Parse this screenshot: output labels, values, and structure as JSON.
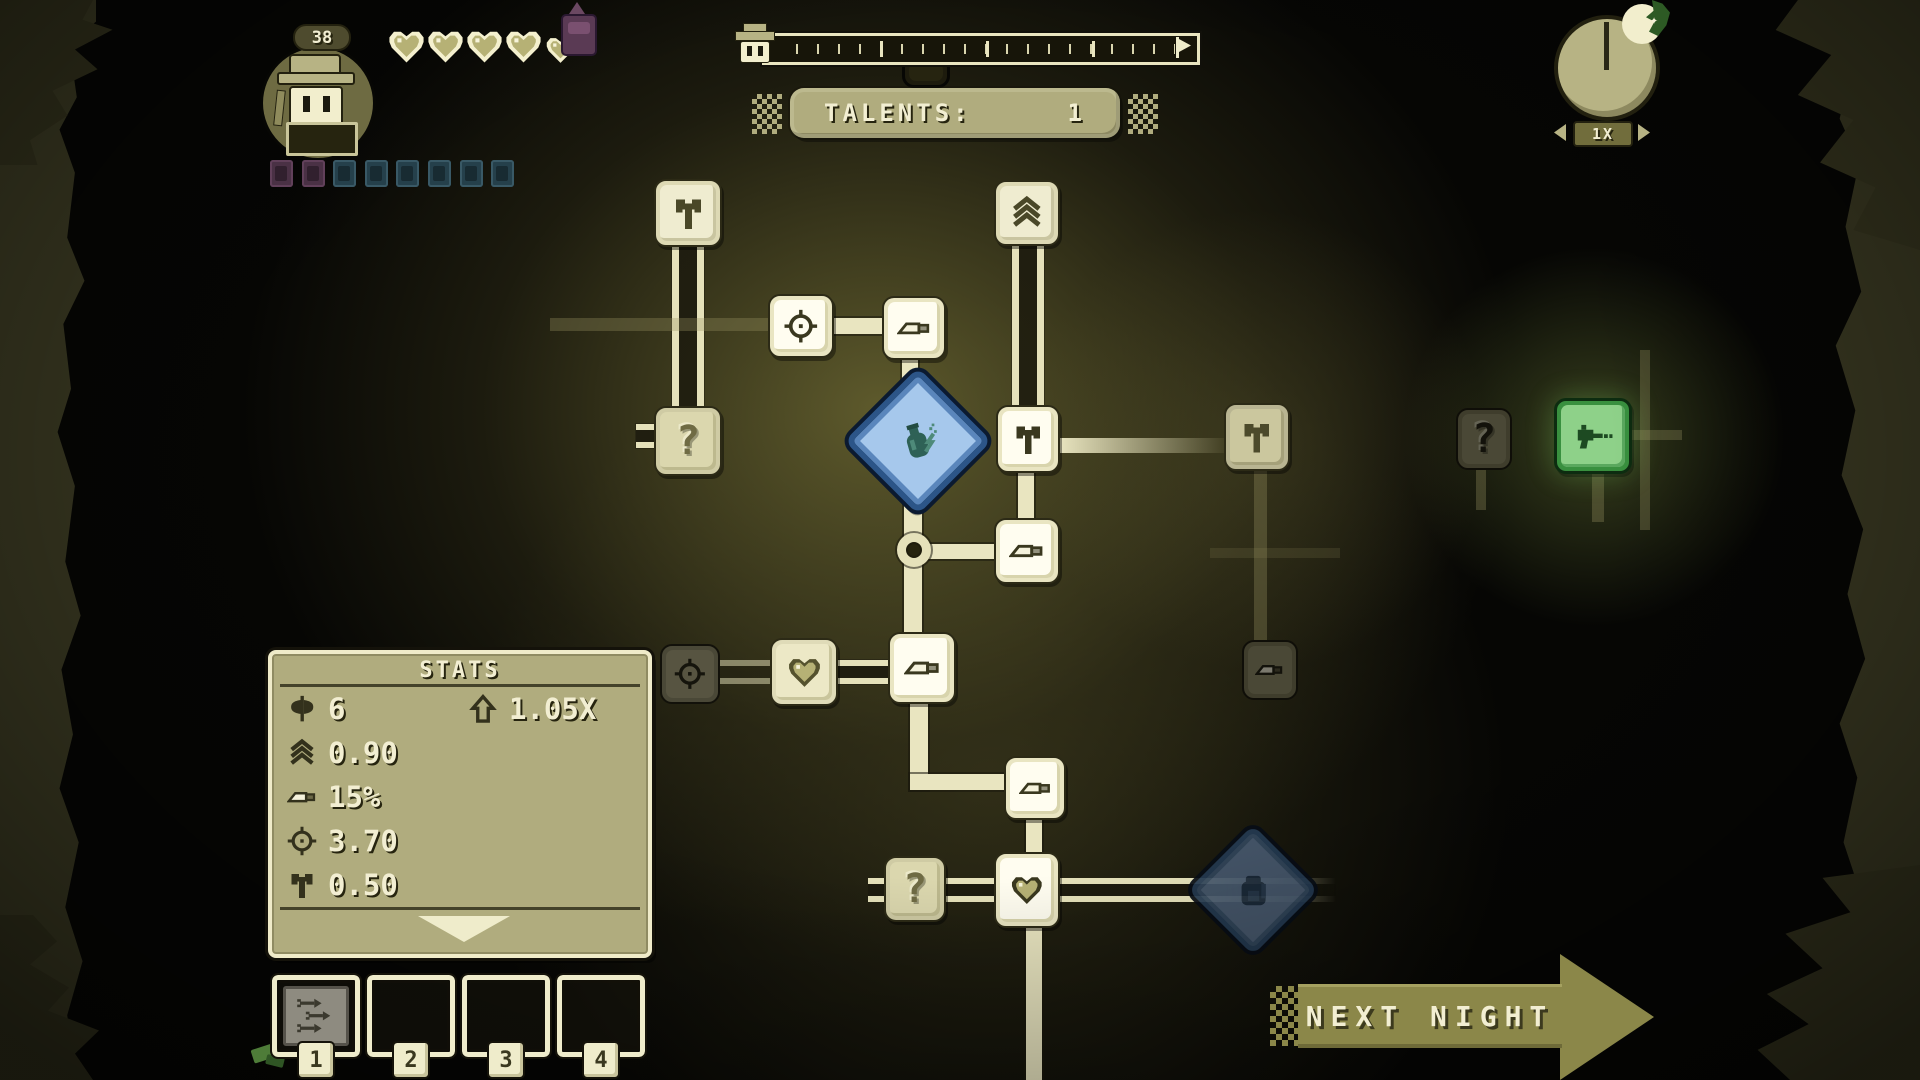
{
  "hud": {
    "level": "38",
    "hearts": {
      "full": 4,
      "small": 1
    },
    "badges": [
      "purple",
      "purple",
      "teal",
      "teal",
      "teal",
      "teal",
      "teal",
      "teal"
    ],
    "talents": {
      "label": "TALENTS:",
      "value": "1"
    },
    "speed": {
      "label": "1X"
    },
    "next_night": {
      "label": "NEXT NIGHT"
    },
    "moon_star": "✦"
  },
  "stats_panel": {
    "title": "STATS",
    "rows": [
      {
        "icon": "axe",
        "value": "6",
        "extra": {
          "icon": "uparrow",
          "value": "1.05X"
        }
      },
      {
        "icon": "chevrons",
        "value": "0.90"
      },
      {
        "icon": "knife",
        "value": "15%"
      },
      {
        "icon": "crosshair",
        "value": "3.70"
      },
      {
        "icon": "hammer",
        "value": "0.50"
      }
    ]
  },
  "item_slots": [
    {
      "number": "1",
      "item": "triple-arrow"
    },
    {
      "number": "2",
      "item": null
    },
    {
      "number": "3",
      "item": null
    },
    {
      "number": "4",
      "item": null
    }
  ],
  "talent_tree": {
    "nodes": [
      {
        "id": "talent-hammer-top",
        "icon": "hammer",
        "style": "soft",
        "x": 654,
        "y": 179,
        "w": 68,
        "h": 68
      },
      {
        "id": "talent-chevrons",
        "icon": "chevrons",
        "style": "soft",
        "x": 994,
        "y": 180,
        "w": 66,
        "h": 66
      },
      {
        "id": "talent-crosshair",
        "icon": "crosshair",
        "style": "white",
        "x": 768,
        "y": 294,
        "w": 66,
        "h": 64
      },
      {
        "id": "talent-knife-1",
        "icon": "knife",
        "style": "white",
        "x": 882,
        "y": 296,
        "w": 64,
        "h": 64
      },
      {
        "id": "talent-question-left",
        "icon": "question",
        "style": "khaki",
        "x": 654,
        "y": 406,
        "w": 68,
        "h": 70
      },
      {
        "id": "talent-hammer-mid",
        "icon": "hammer",
        "style": "white",
        "x": 996,
        "y": 405,
        "w": 64,
        "h": 68
      },
      {
        "id": "talent-hammer-right",
        "icon": "hammer",
        "style": "semi",
        "x": 1224,
        "y": 403,
        "w": 66,
        "h": 68
      },
      {
        "id": "talent-question-dim",
        "icon": "question",
        "style": "dim",
        "x": 1456,
        "y": 408,
        "w": 56,
        "h": 62
      },
      {
        "id": "talent-raygun",
        "icon": "gun",
        "style": "green",
        "x": 1554,
        "y": 398,
        "w": 78,
        "h": 76
      },
      {
        "id": "talent-knife-2",
        "icon": "knife",
        "style": "white",
        "x": 994,
        "y": 518,
        "w": 66,
        "h": 66
      },
      {
        "id": "talent-crosshair-dim",
        "icon": "crosshair",
        "style": "dim2",
        "x": 660,
        "y": 644,
        "w": 60,
        "h": 60
      },
      {
        "id": "talent-heart-1",
        "icon": "heart",
        "style": "khaki2",
        "x": 770,
        "y": 638,
        "w": 68,
        "h": 68
      },
      {
        "id": "talent-knife-3",
        "icon": "knife",
        "style": "white",
        "x": 888,
        "y": 632,
        "w": 68,
        "h": 72
      },
      {
        "id": "talent-knife-dim",
        "icon": "knife",
        "style": "dim",
        "x": 1242,
        "y": 640,
        "w": 56,
        "h": 60
      },
      {
        "id": "talent-knife-4",
        "icon": "knife",
        "style": "white",
        "x": 1004,
        "y": 756,
        "w": 62,
        "h": 64
      },
      {
        "id": "talent-question-bottom",
        "icon": "question",
        "style": "khaki",
        "x": 884,
        "y": 856,
        "w": 62,
        "h": 66
      },
      {
        "id": "talent-heart-2",
        "icon": "heart",
        "style": "white",
        "x": 994,
        "y": 852,
        "w": 66,
        "h": 76
      },
      {
        "id": "talent-diamond-potion",
        "icon": "potion",
        "style": "diamond-blue",
        "x": 866,
        "y": 389,
        "w": 104,
        "h": 104
      },
      {
        "id": "talent-diamond-bag",
        "icon": "bag",
        "style": "diamond-dark",
        "x": 1207,
        "y": 844,
        "w": 92,
        "h": 92
      },
      {
        "id": "talent-hidden-top",
        "icon": "",
        "style": "ghost",
        "x": 902,
        "y": 56,
        "w": 48,
        "h": 32
      }
    ],
    "links": [
      {
        "style": "dualv",
        "x": 672,
        "y": 246,
        "w": 32,
        "h": 162
      },
      {
        "style": "dim",
        "x": 550,
        "y": 318,
        "w": 222,
        "h": 13
      },
      {
        "style": "bright",
        "x": 832,
        "y": 318,
        "w": 52,
        "h": 16
      },
      {
        "style": "bright",
        "x": 902,
        "y": 356,
        "w": 16,
        "h": 40
      },
      {
        "style": "bright",
        "x": 904,
        "y": 486,
        "w": 18,
        "h": 152
      },
      {
        "style": "bright",
        "x": 916,
        "y": 544,
        "w": 80,
        "h": 15
      },
      {
        "style": "bright",
        "x": 1018,
        "y": 471,
        "w": 16,
        "h": 48
      },
      {
        "style": "dualv",
        "x": 1012,
        "y": 246,
        "w": 32,
        "h": 160
      },
      {
        "style": "fadeh",
        "x": 1058,
        "y": 438,
        "w": 168,
        "h": 15
      },
      {
        "style": "dim",
        "x": 1254,
        "y": 469,
        "w": 13,
        "h": 172
      },
      {
        "style": "dimmer",
        "x": 1210,
        "y": 548,
        "w": 130,
        "h": 10
      },
      {
        "style": "dualh-dim",
        "x": 718,
        "y": 660,
        "w": 54,
        "h": 24
      },
      {
        "style": "dualh",
        "x": 836,
        "y": 660,
        "w": 54,
        "h": 24
      },
      {
        "style": "bright",
        "x": 910,
        "y": 700,
        "w": 18,
        "h": 90
      },
      {
        "style": "bright",
        "x": 910,
        "y": 774,
        "w": 96,
        "h": 16
      },
      {
        "style": "bright",
        "x": 1026,
        "y": 818,
        "w": 16,
        "h": 36
      },
      {
        "style": "bright",
        "x": 1026,
        "y": 926,
        "w": 16,
        "h": 154
      },
      {
        "style": "dualh-fade",
        "x": 868,
        "y": 878,
        "w": 478,
        "h": 24
      },
      {
        "style": "dualh",
        "x": 636,
        "y": 424,
        "w": 20,
        "h": 24
      },
      {
        "style": "dim",
        "x": 1640,
        "y": 350,
        "w": 10,
        "h": 180
      },
      {
        "style": "dim",
        "x": 1592,
        "y": 472,
        "w": 12,
        "h": 50
      },
      {
        "style": "dim",
        "x": 1630,
        "y": 430,
        "w": 52,
        "h": 10
      },
      {
        "style": "dim",
        "x": 1476,
        "y": 466,
        "w": 10,
        "h": 44
      }
    ],
    "ring": {
      "x": 897,
      "y": 533,
      "w": 34,
      "h": 34
    }
  },
  "colors": {
    "cream": "#efeccb",
    "panel_khaki": "#b0ac7e",
    "night_olive": "#8b8749",
    "diamond_blue": "#a6c8ec",
    "unlock_green": "#8ed189",
    "bg_glow": "#5e5a2c"
  }
}
